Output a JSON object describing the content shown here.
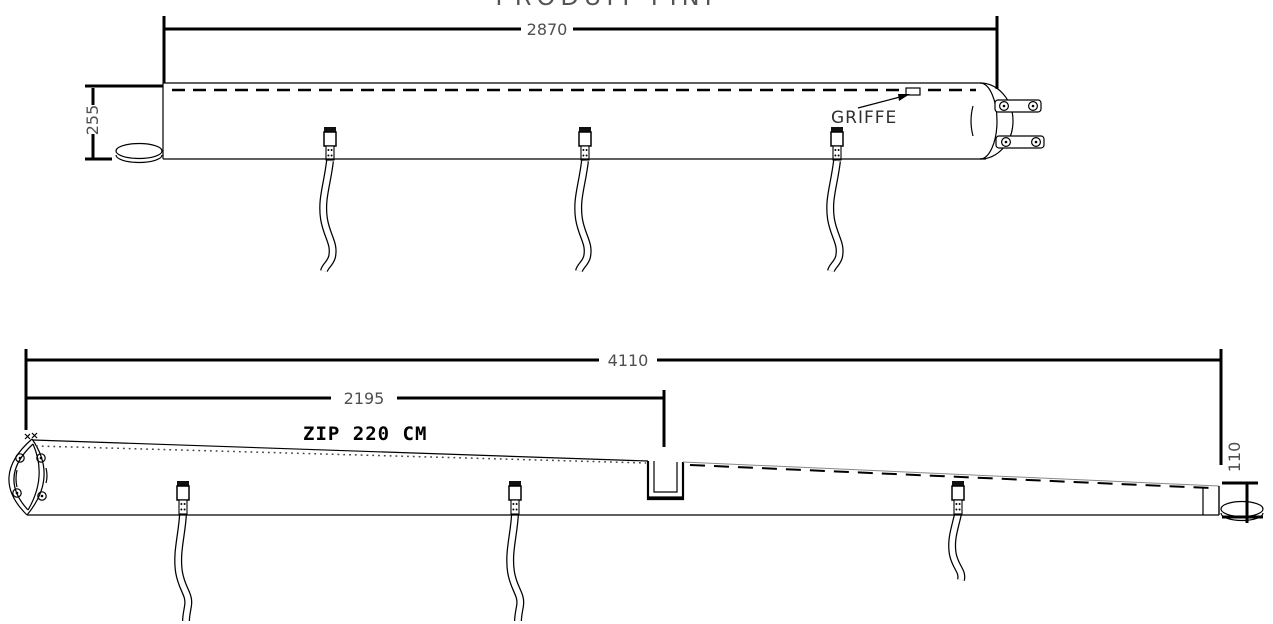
{
  "title": "PRODUIT FINI",
  "colors": {
    "line": "#000000",
    "dim_text": "#4f4f4f",
    "label_text": "#2f2f2f",
    "edge_muted": "#888888",
    "background": "#ffffff"
  },
  "top_view": {
    "length_dim": "2870",
    "height_dim": "255",
    "griffe_label": "GRIFFE",
    "strap_count": "3"
  },
  "bottom_view": {
    "overall_length_dim": "4110",
    "zip_extent_dim": "2195",
    "zip_label": "ZIP 220 CM",
    "end_height_dim": "110",
    "strap_count": "3"
  }
}
